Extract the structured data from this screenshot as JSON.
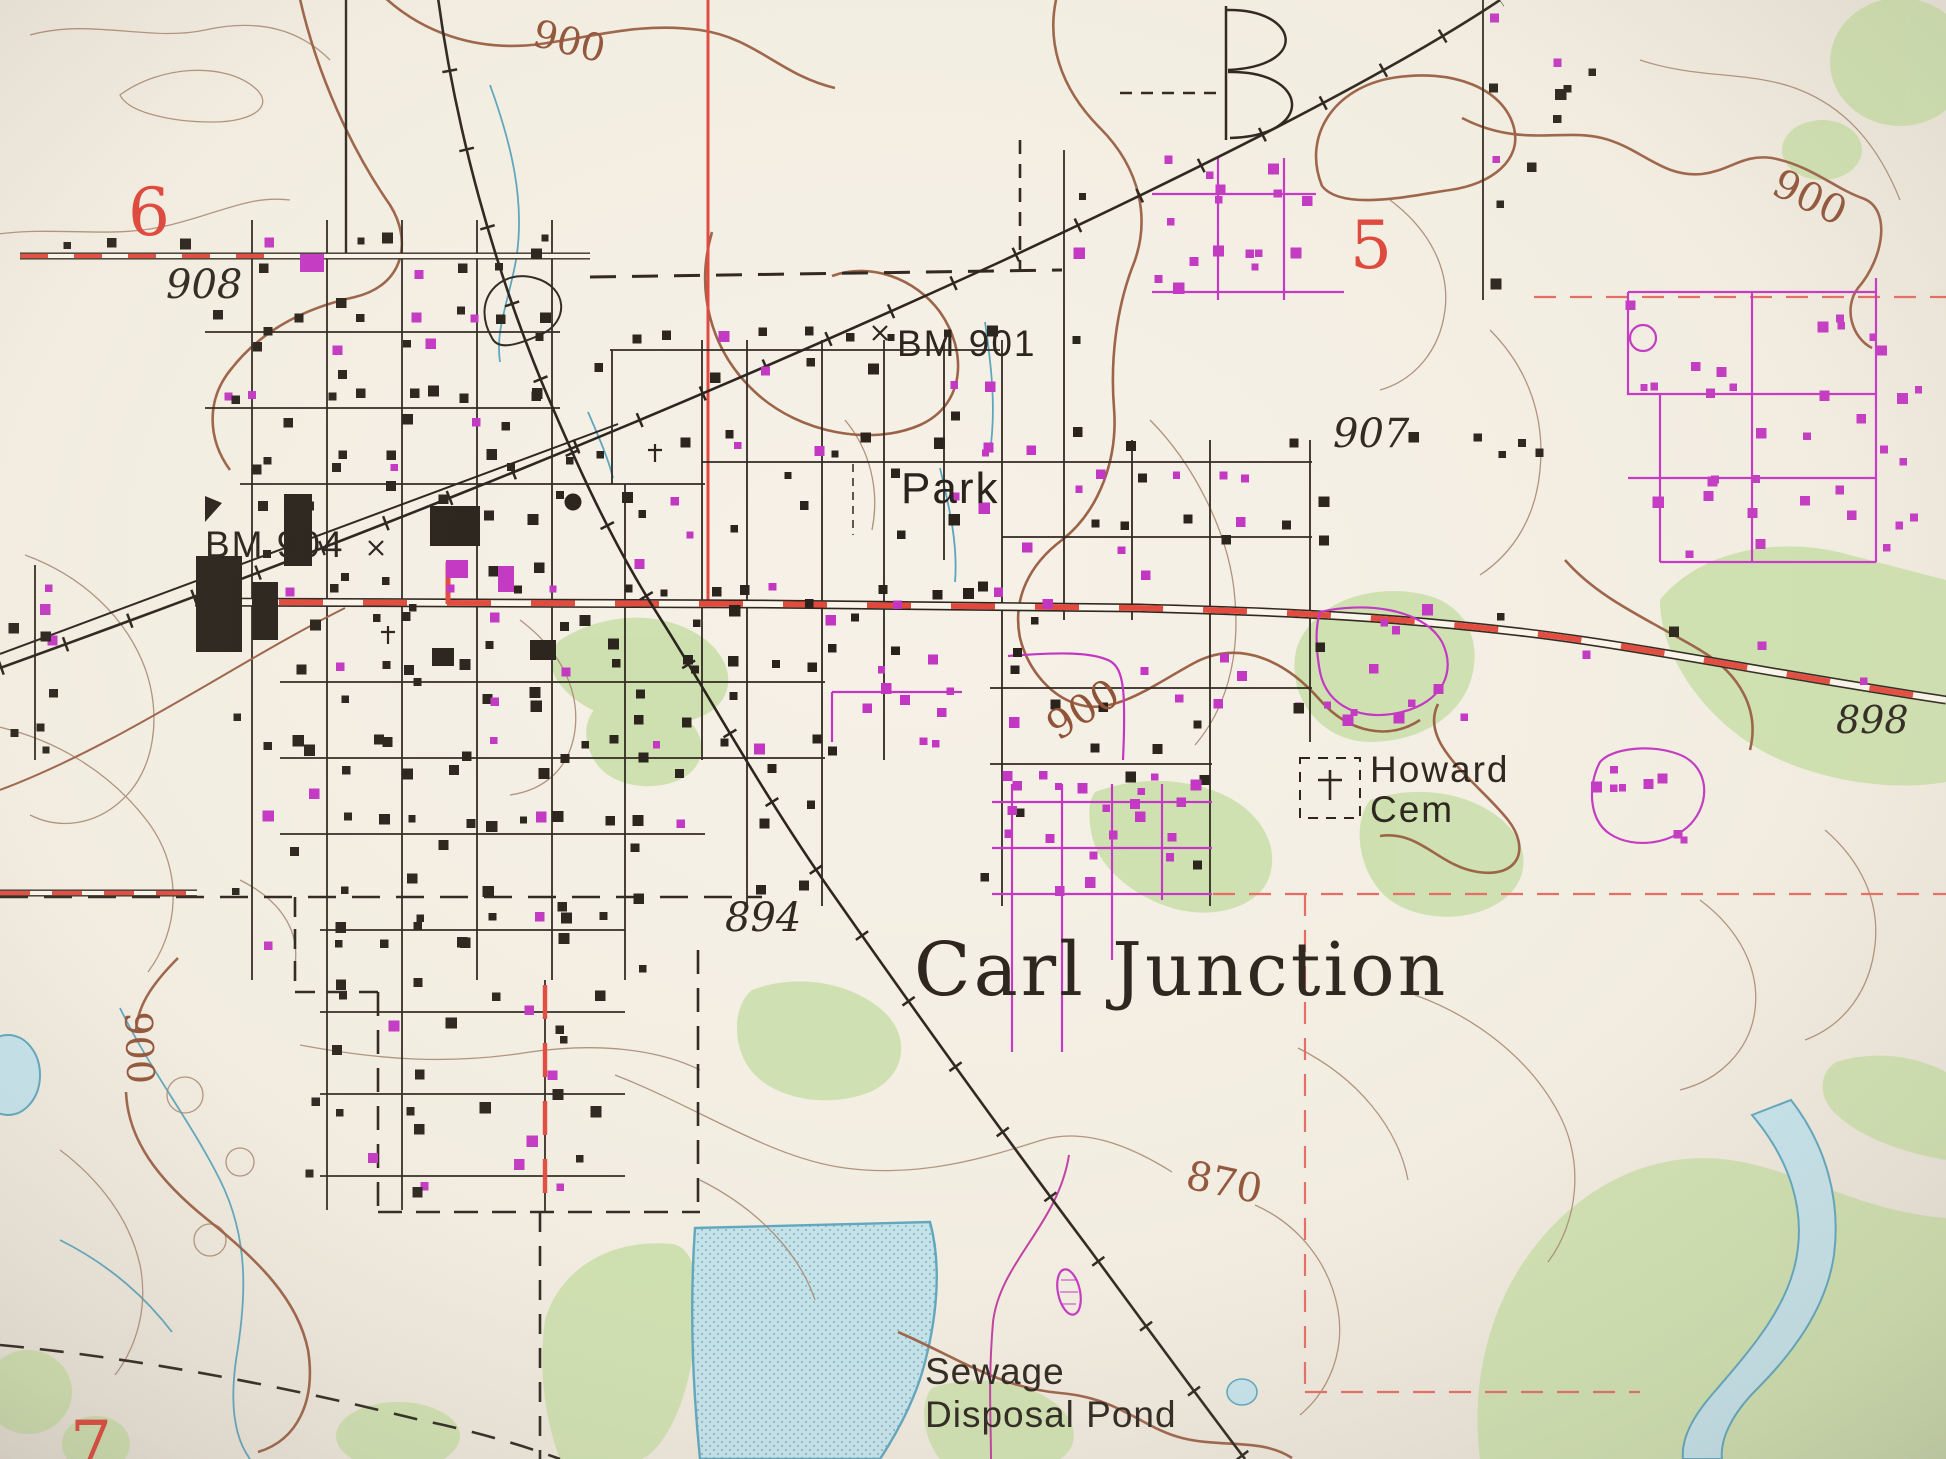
{
  "map": {
    "region_name": "Carl Junction",
    "palette": {
      "paper": "#f4efe4",
      "ink": "#27211a",
      "section_red": "#de4337",
      "road_red": "#e2483b",
      "magenta": "#c235c2",
      "contour_brown": "#96593c",
      "water_fill": "#c3e2ea",
      "water_line": "#5ba4bd",
      "vegetation_green": "#cadfaa"
    },
    "labels": {
      "section6": "6",
      "section5": "5",
      "section7": "7",
      "spot908": "908",
      "spot907": "907",
      "spot894": "894",
      "spot898": "898",
      "bm901": "BM 901",
      "bm904": "BM 904",
      "contour900": "900",
      "contour870": "870",
      "park": "Park",
      "howardCem1": "Howard",
      "howardCem2": "Cem",
      "town": "Carl Junction",
      "sewage1": "Sewage",
      "sewage2": "Disposal Pond"
    }
  }
}
